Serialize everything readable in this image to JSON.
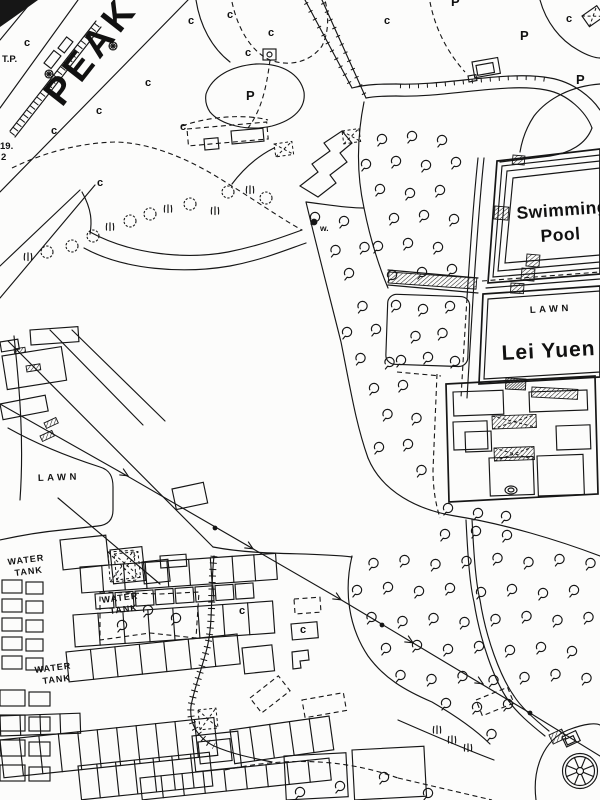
{
  "map": {
    "road_name": "PEAK",
    "swimming_pool": {
      "line1": "Swimming",
      "line2": "Pool"
    },
    "lei_yuen": {
      "name": "Lei Yuen",
      "lawn_label": "LAWN"
    },
    "west_lawn_label": "LAWN",
    "water_tank": {
      "line1": "WATER",
      "line2": "TANK"
    },
    "marks": {
      "telephone_post": "T.P.",
      "lot_number_upper": "19.",
      "lot_number_lower": "2",
      "well": "w."
    },
    "land_codes": {
      "cultivated": "c",
      "plantation": "P"
    }
  }
}
